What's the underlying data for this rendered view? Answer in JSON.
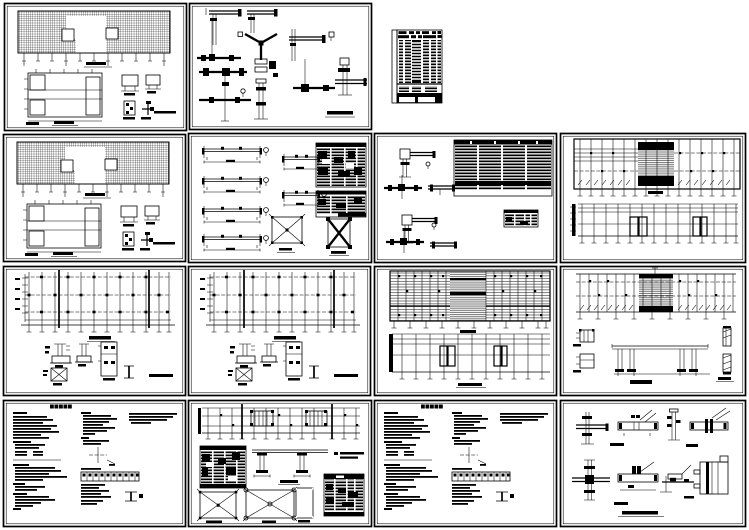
{
  "canvas": {
    "width": 749,
    "height": 530
  },
  "colors": {
    "paper": "#ffffff",
    "ink": "#000000"
  },
  "board": {
    "description": "Preview collage of fifteen structural-engineering CAD sheets arranged in a 4x4 grid, all black line work on white paper",
    "sheets": [
      {
        "label": "floor framing plan with rebar hatching, foundation plan and slab details"
      },
      {
        "label": "steel beam-column connection details sheet"
      },
      {
        "label": "drawing index schedule table"
      },
      {
        "label": "floor framing plan with rebar hatching (second copy)"
      },
      {
        "label": "beam elevation details with member schedules and braced panels"
      },
      {
        "label": "column joint details with large member schedule table"
      },
      {
        "label": "roof framing plan over column grid plan"
      },
      {
        "label": "column grid plan with footing and anchor details"
      },
      {
        "label": "column grid plan with footing and anchor details (second copy)"
      },
      {
        "label": "floor framing plan over wall layout plan"
      },
      {
        "label": "roof framing plan with section and channel details"
      },
      {
        "label": "structural design general notes sheet"
      },
      {
        "label": "grid plan, bracing elevations and schedules sheet"
      },
      {
        "label": "structural design general notes sheet (second copy)"
      },
      {
        "label": "beam-column connection details sheet 2"
      }
    ]
  }
}
